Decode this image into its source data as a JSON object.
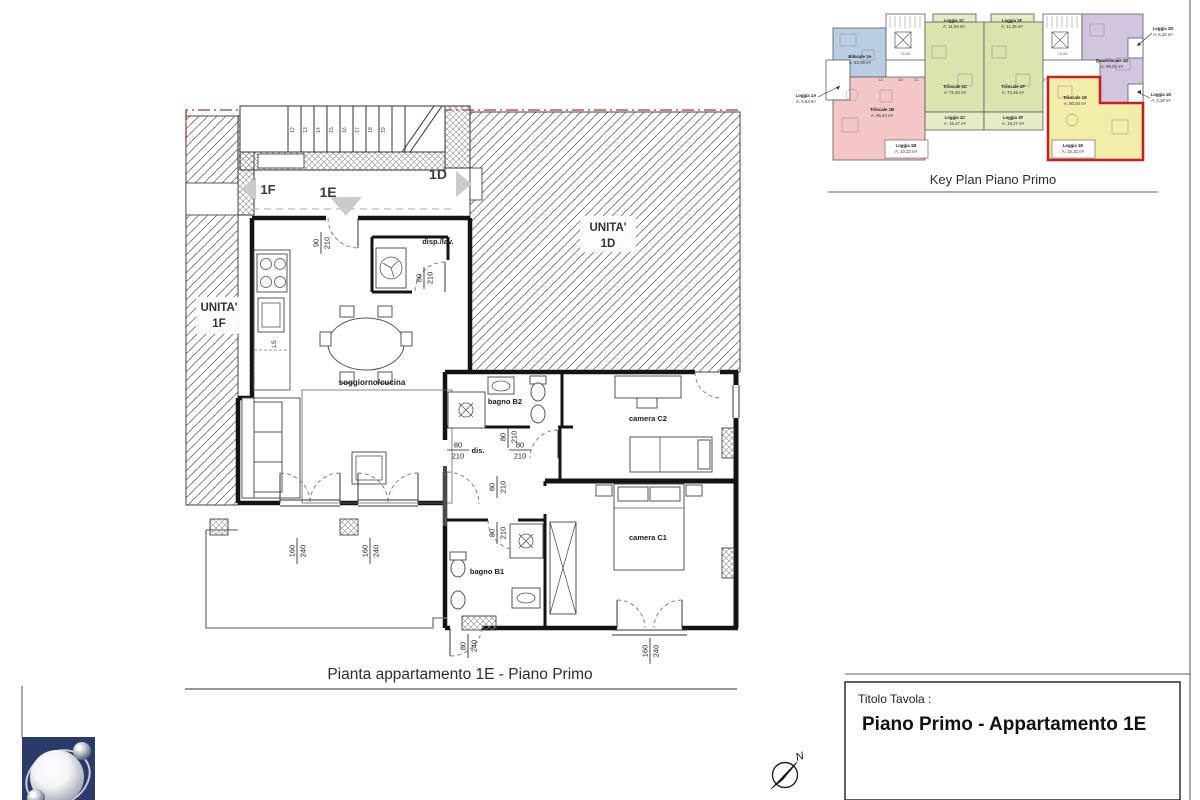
{
  "sheet": {
    "caption": "Pianta appartamento 1E - Piano Primo",
    "key_plan_title": "Key Plan Piano Primo",
    "title_block_label": "Titolo Tavola :",
    "title_block_title": "Piano Primo - Appartamento 1E",
    "north_label": "N"
  },
  "main_plan": {
    "neighbors": {
      "left_line1": "UNITA'",
      "left_line2": "1F",
      "right_line1": "UNITA'",
      "right_line2": "1D"
    },
    "corridor": {
      "unit_left": "1F",
      "unit_center": "1E",
      "unit_right": "1D"
    },
    "rooms": {
      "living": "soggiorno/cucina",
      "pantry": "disp./lav.",
      "bath2": "bagno B2",
      "bedroom2": "camera C2",
      "hall": "dis.",
      "bath1": "bagno B1",
      "bedroom1": "camera C1",
      "kitchen_sink": "LS"
    },
    "stair_numbers": [
      "12",
      "13",
      "14",
      "15",
      "16",
      "17",
      "18",
      "19"
    ],
    "dims": {
      "entry": {
        "w": "90",
        "h": "210"
      },
      "pantry_door": {
        "w": "80",
        "h": "210"
      },
      "hall_top": {
        "w": "80",
        "h": "210"
      },
      "hall_left": {
        "w": "80",
        "h": "210"
      },
      "hall_right": {
        "w": "80",
        "h": "210"
      },
      "hall_mid": {
        "w": "80",
        "h": "210"
      },
      "hall_bottom": {
        "w": "80",
        "h": "210"
      },
      "living_window1": {
        "w": "160",
        "h": "240"
      },
      "living_window2": {
        "w": "160",
        "h": "240"
      },
      "bath1_door": {
        "w": "80",
        "h": "240"
      },
      "bedroom1_window": {
        "w": "160",
        "h": "240"
      }
    }
  },
  "key_plan": {
    "units": [
      {
        "name": "Bilocale 1A",
        "area": "A: 63,08 m²"
      },
      {
        "name": "Trilocale 1B",
        "area": "A: 85,44 m²"
      },
      {
        "name": "Trilocale 1C",
        "area": "A: 72,40 m²"
      },
      {
        "name": "Trilocale 1F",
        "area": "A: 72,46 m²"
      },
      {
        "name": "Trilocale 1E",
        "area": "A: 80,04 m²"
      },
      {
        "name": "Quadrilocale 1D",
        "area": "A: 98,01 m²"
      }
    ],
    "loggias": [
      {
        "name": "Loggia 1A",
        "area": "A: 6,63 m²"
      },
      {
        "name": "Loggia 1B",
        "area": "A: 10,22 m²"
      },
      {
        "name": "Loggia 1C",
        "area": "A: 11,94 m²"
      },
      {
        "name": "Loggia 1C",
        "area": "A: 16,27 m²"
      },
      {
        "name": "Loggia 1F",
        "area": "A: 11,36 m²"
      },
      {
        "name": "Loggia 1F",
        "area": "A: 15,27 m²"
      },
      {
        "name": "Loggia 1E",
        "area": "A: 16,32 m²"
      },
      {
        "name": "Loggia 1D",
        "area": "A: 6,32 m²"
      },
      {
        "name": "Loggia 1D",
        "area": "A: 3,18 m²"
      }
    ],
    "core_labels": [
      "1A",
      "1B",
      "1C",
      "1F"
    ],
    "level_mark": "+3,40",
    "colors": {
      "unit_1A": "#b9cde3",
      "unit_1B": "#f4c7c7",
      "unit_1C": "#dbe3ae",
      "unit_1F": "#dbe3ae",
      "unit_1E": "#f3edaa",
      "unit_1D": "#d2c6de",
      "loggia_strip": "#e6eac6",
      "highlight_border": "#c42222"
    }
  }
}
